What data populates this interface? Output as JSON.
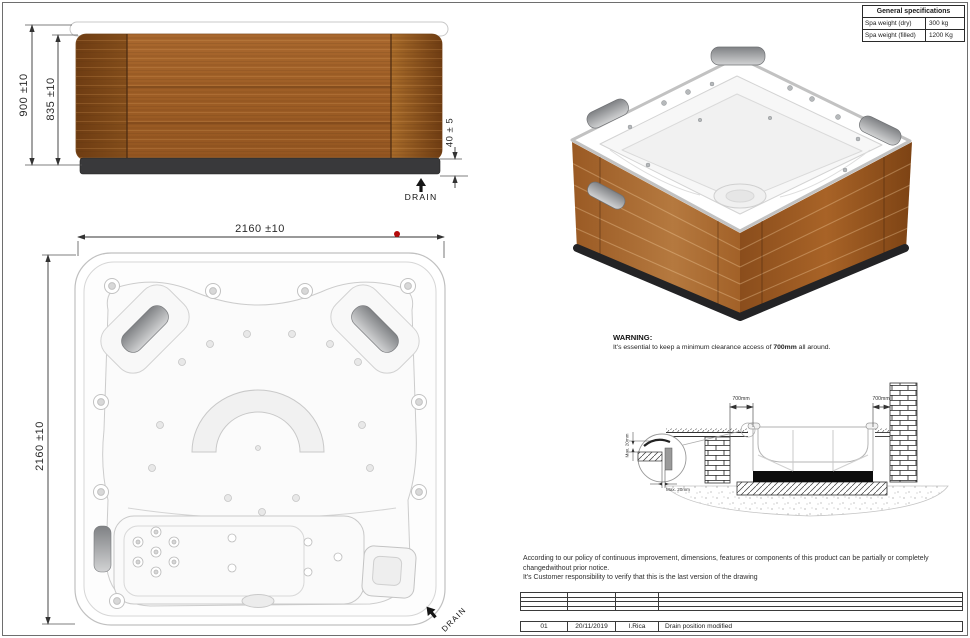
{
  "spec_table": {
    "title": "General specifications",
    "rows": [
      {
        "label": "Spa weight (dry)",
        "value": "300 kg"
      },
      {
        "label": "Spa weight (filled)",
        "value": "1200 Kg"
      }
    ]
  },
  "side_view": {
    "dim_height_outer": "900 ±10",
    "dim_height_panel": "835 ±10",
    "dim_base_height": "40 ± 5",
    "drain_label": "DRAIN"
  },
  "plan_view": {
    "dim_width": "2160 ±10",
    "dim_depth": "2160 ±10",
    "drain_label": "DRAIN"
  },
  "warning": {
    "title": "WARNING:",
    "text_before": "It's essential to keep a minimum clearance access of ",
    "text_bold": "700mm",
    "text_after": " all around."
  },
  "section_view": {
    "clearance_left": "700mm",
    "clearance_right": "700mm",
    "detail_gap_vertical": "Max. 20mm",
    "detail_gap_horizontal": "Max. 20mm"
  },
  "disclaimer": {
    "line1": "According to our policy of continuous improvement, dimensions, features or components of this product can be partially or completely",
    "line2": "changedwithout prior notice.",
    "line3": "It's Customer responsibility to verify that this is the last version of the drawing"
  },
  "revision_table": {
    "rows": [
      {
        "rev": "01",
        "date": "20/11/2019",
        "author": "I.Rica",
        "description": "Drain position modified"
      }
    ]
  },
  "colors": {
    "wood_dark": "#7a4517",
    "wood_mid": "#a5622a",
    "wood_light": "#c78d44",
    "base_dark": "#39393b",
    "line_gray": "#c6c6c6",
    "marker_red": "#b40a0a"
  }
}
